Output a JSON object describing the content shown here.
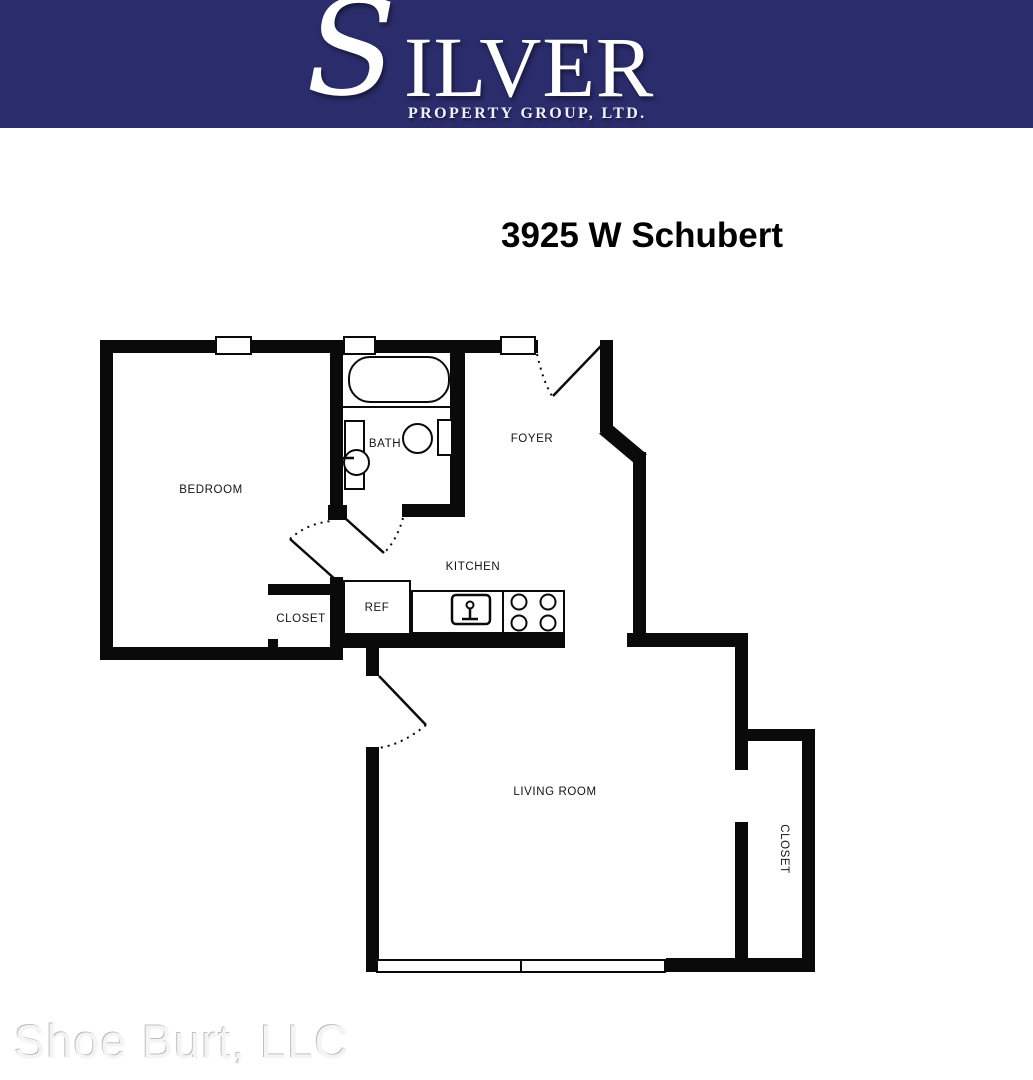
{
  "header": {
    "brand": {
      "initial": "S",
      "rest": "ILVER",
      "subtitle": "PROPERTY GROUP, LTD."
    }
  },
  "title": "3925 W Schubert",
  "floorplan": {
    "labels": {
      "bedroom": "BEDROOM",
      "bath": "BATH",
      "foyer": "FOYER",
      "kitchen": "KITCHEN",
      "bedroom_closet": "CLOSET",
      "refrigerator": "REF",
      "living_room": "LIVING ROOM",
      "living_room_closet": "CLOSET"
    }
  },
  "watermark": "Shoe Burt, LLC",
  "colors": {
    "header_navy": "#2b2c6b",
    "wall_black": "#0a0a0a",
    "watermark_gray": "#f4f4f4"
  }
}
